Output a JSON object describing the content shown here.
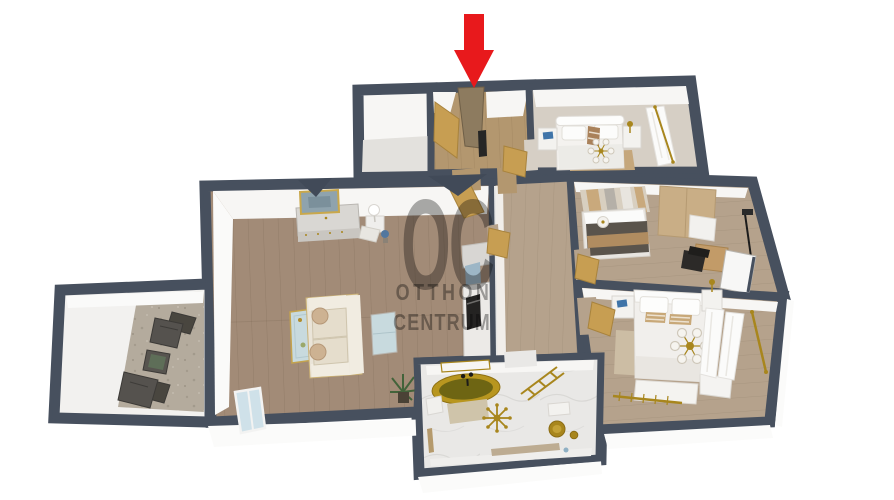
{
  "scene": {
    "kind": "3d-apartment-floorplan-render",
    "entrance_marker": {
      "shape": "down-arrow",
      "points_at": "front-door"
    }
  },
  "watermark": {
    "monogram": "OC",
    "line1": "OTTHON",
    "line2": "CENTRUM"
  },
  "palette": {
    "wall": "#47505e",
    "wall-shadow": "#414a58",
    "wall-face": "#f7f6f4",
    "exterior-face": "#fbfbfa",
    "floor-wood": "#a28b77",
    "floor-wood-warm": "#b3976f",
    "floor-wood-soft": "#b5a28c",
    "floor-bedroom1": "#d6cfc5",
    "floor-marble": "#e9e8e6",
    "floor-concrete": "#b4ab9d",
    "gold": "#a8861d",
    "door": "#c79e52",
    "door-dark": "#8d7b5f",
    "ink": "#262625",
    "furn-white": "#f3f2ef",
    "sofa-cream": "#eae4d8",
    "wardrobe-tan": "#c9ae86",
    "accent-blue": "#3f74a8",
    "glass-blue": "#c8dade",
    "blanket-dark": "#5a544c",
    "arrow": "#e8191c",
    "watermark": "#989898"
  },
  "rooms": [
    {
      "id": "entry-closet",
      "furniture": []
    },
    {
      "id": "entrance-hall",
      "furniture": [
        "front-door",
        "open-door",
        "coat-rack",
        "door-to-bedroom-1"
      ]
    },
    {
      "id": "bedroom-1",
      "furniture": [
        "double-bed",
        "ceiling-lamp",
        "nightstand",
        "nightstand",
        "curtained-window",
        "rug"
      ]
    },
    {
      "id": "bedroom-2",
      "furniture": [
        "bed",
        "ceiling-lamp",
        "wardrobe",
        "desk",
        "desk-chair",
        "floor-lamp",
        "striped-rug",
        "window"
      ]
    },
    {
      "id": "bedroom-3",
      "furniture": [
        "double-bed",
        "chandelier",
        "nightstand",
        "nightstand",
        "bench",
        "dresser",
        "curtained-window",
        "gold-radiator",
        "rug"
      ]
    },
    {
      "id": "living-room",
      "furniture": [
        "sofa",
        "coffee-table",
        "side-table",
        "sideboard",
        "wall-picture",
        "table-lamp",
        "armchair",
        "plant",
        "kitchenette",
        "oven",
        "window"
      ]
    },
    {
      "id": "corridor",
      "furniture": [
        "open-door",
        "open-door",
        "open-door"
      ]
    },
    {
      "id": "bathroom",
      "furniture": [
        "freestanding-gold-bathtub",
        "mirror",
        "bath-mat",
        "towel",
        "ladder-towel-rack",
        "chandelier",
        "toilet",
        "waste-bin",
        "radiator-shelf"
      ]
    },
    {
      "id": "balcony",
      "furniture": [
        "lounge-chair",
        "side-table",
        "lounge-chair"
      ]
    }
  ]
}
